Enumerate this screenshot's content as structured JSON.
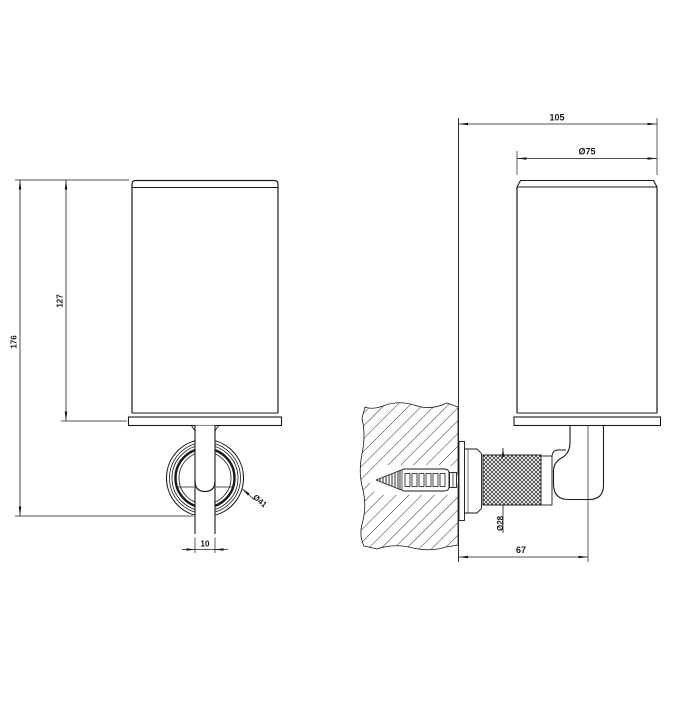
{
  "colors": {
    "line": "#1a1a1a",
    "background": "#ffffff"
  },
  "views": {
    "front": {
      "dims": {
        "overall_height": "176",
        "cup_height": "127",
        "rosette_diameter": "Ø41",
        "stem_width": "10"
      }
    },
    "side": {
      "dims": {
        "overall_depth": "105",
        "cup_diameter": "Ø75",
        "knurl_diameter": "Ø28",
        "wall_to_holder": "67"
      }
    }
  }
}
